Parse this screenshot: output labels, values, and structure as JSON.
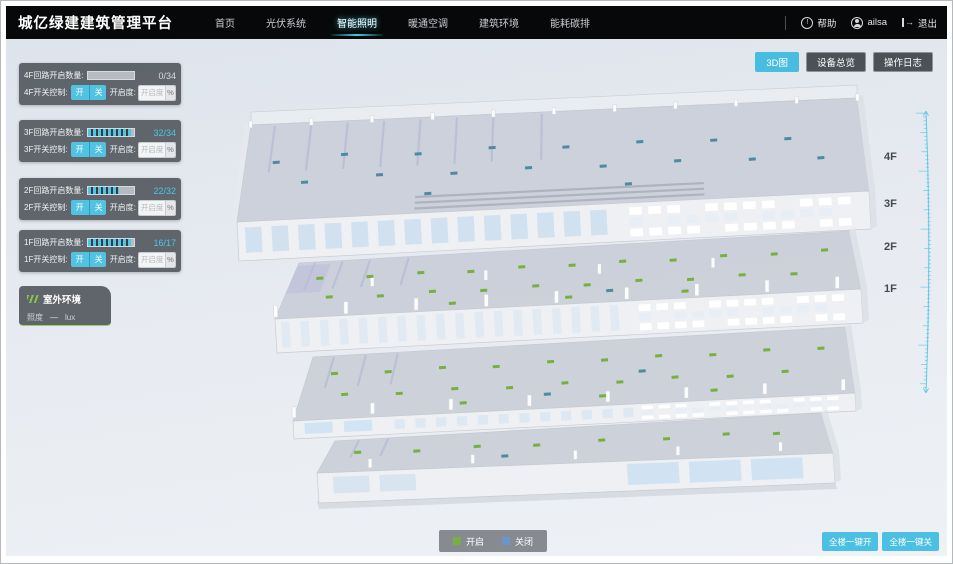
{
  "header": {
    "title": "城亿绿建建筑管理平台",
    "nav": [
      {
        "label": "首页",
        "active": false
      },
      {
        "label": "光伏系统",
        "active": false
      },
      {
        "label": "智能照明",
        "active": true
      },
      {
        "label": "暖通空调",
        "active": false
      },
      {
        "label": "建筑环境",
        "active": false
      },
      {
        "label": "能耗碳排",
        "active": false
      }
    ],
    "help_label": "帮助",
    "username": "ailsa",
    "logout_label": "退出",
    "icons": {
      "help": "!"
    }
  },
  "toolbar": {
    "buttons": [
      {
        "label": "3D图",
        "active": true
      },
      {
        "label": "设备总览",
        "active": false
      },
      {
        "label": "操作日志",
        "active": false
      }
    ]
  },
  "floor_panels": [
    {
      "count_label": "4F回路开启数量:",
      "count": "0/34",
      "progress": 0,
      "switch_label": "4F开关控制:",
      "on_label": "开",
      "off_label": "关",
      "dim_label": "开启度:",
      "dim_placeholder": "开启度",
      "percent_label": "%"
    },
    {
      "count_label": "3F回路开启数量:",
      "count": "32/34",
      "progress": 94,
      "switch_label": "3F开关控制:",
      "on_label": "开",
      "off_label": "关",
      "dim_label": "开启度:",
      "dim_placeholder": "开启度",
      "percent_label": "%"
    },
    {
      "count_label": "2F回路开启数量:",
      "count": "22/32",
      "progress": 69,
      "switch_label": "2F开关控制:",
      "on_label": "开",
      "off_label": "关",
      "dim_label": "开启度:",
      "dim_placeholder": "开启度",
      "percent_label": "%"
    },
    {
      "count_label": "1F回路开启数量:",
      "count": "16/17",
      "progress": 94,
      "switch_label": "1F开关控制:",
      "on_label": "开",
      "off_label": "关",
      "dim_label": "开启度:",
      "dim_placeholder": "开启度",
      "percent_label": "%"
    }
  ],
  "outdoor": {
    "title": "室外环境",
    "metric_label": "照度",
    "metric_value": "—",
    "metric_unit": "lux"
  },
  "floor_labels": [
    "4F",
    "3F",
    "2F",
    "1F"
  ],
  "legend": {
    "on_label": "开启",
    "off_label": "关闭",
    "on_color": "#76b041",
    "off_color": "#6a96cc"
  },
  "bulk": {
    "all_on": "全楼一键开",
    "all_off": "全楼一键关"
  },
  "colors": {
    "accent": "#4ec6e8",
    "marker_off": "#4d8ba0"
  }
}
